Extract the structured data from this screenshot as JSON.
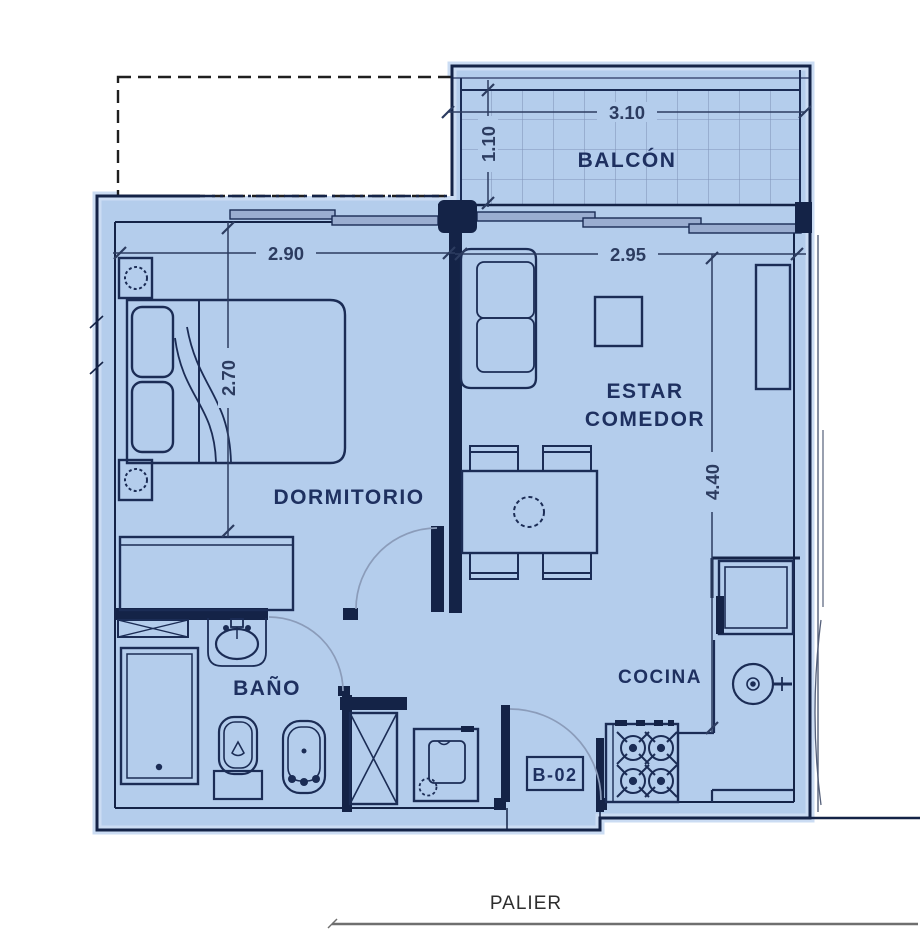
{
  "labels": {
    "balcony": "BALCÓN",
    "bedroom": "DORMITORIO",
    "living_line1": "ESTAR",
    "living_line2": "COMEDOR",
    "bathroom": "BAÑO",
    "kitchen": "COCINA",
    "unit": "B-02",
    "landing": "PALIER"
  },
  "dimensions": {
    "balcony_width": "3.10",
    "balcony_depth": "1.10",
    "bedroom_width": "2.90",
    "bedroom_depth": "2.70",
    "living_width": "2.95",
    "living_depth": "4.40"
  },
  "colors": {
    "floor_fill": "#b4cdec",
    "floor_halo": "#cbdcf3",
    "wall": "#142347",
    "furniture_line": "#1b2c55",
    "tile_line": "#8094ba",
    "window_panel": "#9aadd0",
    "door_arc": "#8b9cba",
    "label_text": "#1e3060",
    "dim_text": "#2c3c60",
    "landing_text": "#2e2e2e",
    "landing_line": "#6f6f6f"
  }
}
